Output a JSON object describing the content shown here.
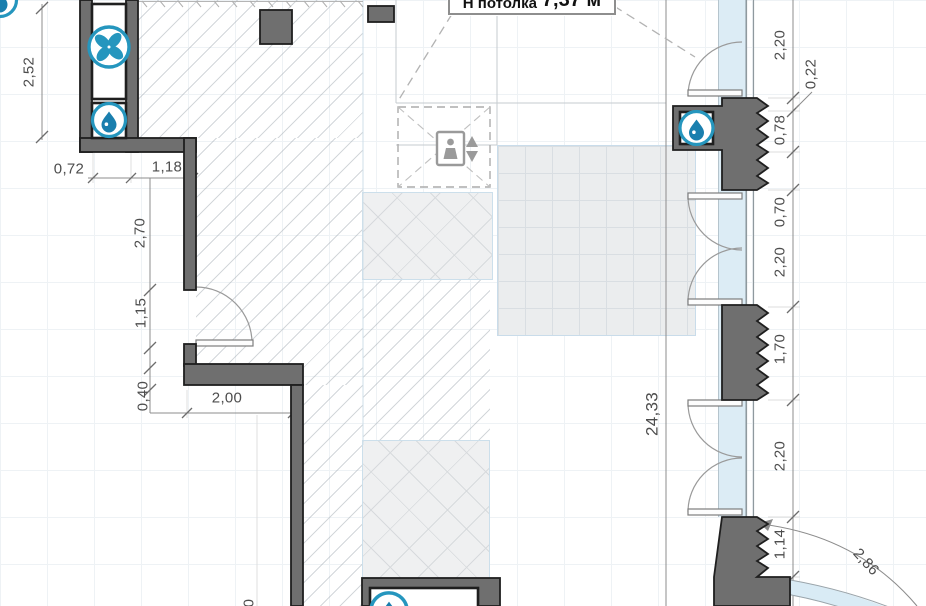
{
  "drawing": {
    "kind": "apartment floor plan fragment",
    "label_box": {
      "prefix": "Н потолка",
      "value": "7,37 м"
    }
  },
  "dims": {
    "shaft_height": "2,52",
    "shaft_width": "0,72",
    "wall_top": "1,18",
    "wall_upper": "2,70",
    "door_left": "1,15",
    "wall_thick": "0,40",
    "room_width": "2,00",
    "partial_bottom": "0",
    "total_height": "24,33",
    "win_top": "2,20",
    "win_small": "0,22",
    "pier_a1": "0,78",
    "pier_a2": "0,70",
    "door_a": "2,20",
    "pier_mid": "1,70",
    "door_b": "2,20",
    "pier_low": "1,14",
    "arc_radius": "2,86"
  },
  "icons": {
    "fan": "ventilation-fan",
    "water": "water-supply-drop",
    "elevator": "elevator-cab"
  },
  "colors": {
    "accent_blue": "#2596be",
    "drop_blue": "#1a7fae",
    "wall_gray": "#6f6f6f",
    "glazing_blue": "#dcecf5"
  }
}
